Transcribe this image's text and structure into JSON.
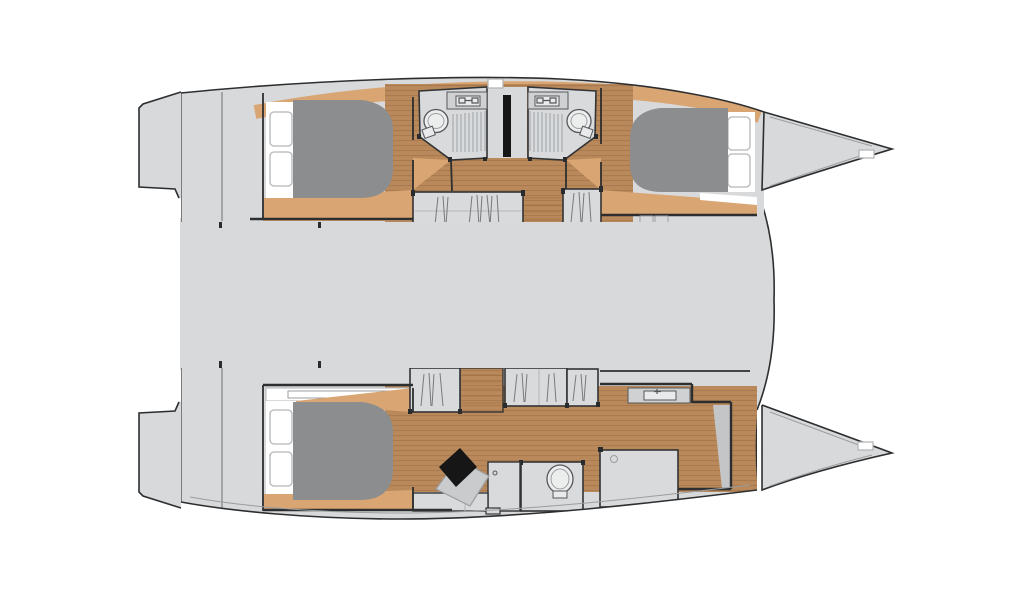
{
  "meta": {
    "title": "Catamaran yacht deck floor plan",
    "type": "floorplan-diagram",
    "visible_text": []
  },
  "palette": {
    "background": "#ffffff",
    "deck": "#d8d9da",
    "outline": "#2d2e30",
    "wall_light": "#6b6e70",
    "wood_floor": "#b9895b",
    "wood_plank_line": "#97693f",
    "wood_trim": "#d9a572",
    "bed": "#8b8d8f",
    "room": "#d9dadb",
    "room_outline": "#323334",
    "fixture": "#eceeee",
    "fixture_outline": "#55585a",
    "sink_unit": "#cfd1d2",
    "sink_basin": "#e9eaeb",
    "desk": "#c9cbcc",
    "gray_strip": "#c3c5c7",
    "charcoal": "#4e5052",
    "black": "#161616",
    "hatch_fill": "#ffffff",
    "hatch_border": "#b4b6b8",
    "grate_line": "#a3a7aa",
    "hanger_line": "#77797c",
    "shelf_line": "#b4b6b8",
    "inner_edge": "#9b9ea0",
    "post": "#2a2b2c"
  },
  "vessel": {
    "kind": "catamaran",
    "view": "overhead-deck-plan",
    "bow_direction": "right",
    "hulls": [
      {
        "id": "port-hull",
        "position": "top",
        "rooms": [
          "aft-double-cabin",
          "head-with-shower-aft",
          "head-with-shower-forward",
          "wardrobes",
          "companionway-steps",
          "forward-double-cabin",
          "bow-locker"
        ]
      },
      {
        "id": "starboard-hull",
        "position": "bottom",
        "rooms": [
          "owner-double-cabin",
          "wardrobes",
          "companionway-steps",
          "vanity-desk-with-stool",
          "toilet-room",
          "shower-room",
          "bow-locker"
        ]
      }
    ],
    "bridgedeck": "open-gray-deck-between-hulls",
    "fixture_counts": {
      "double_berths": 3,
      "toilets": 3,
      "sinks": 3,
      "shower_grates": 2,
      "wardrobe_units": 5,
      "deck_hatches": 6,
      "small_center_hatch": 1,
      "stool": 1,
      "bow_cleats": 2
    }
  }
}
